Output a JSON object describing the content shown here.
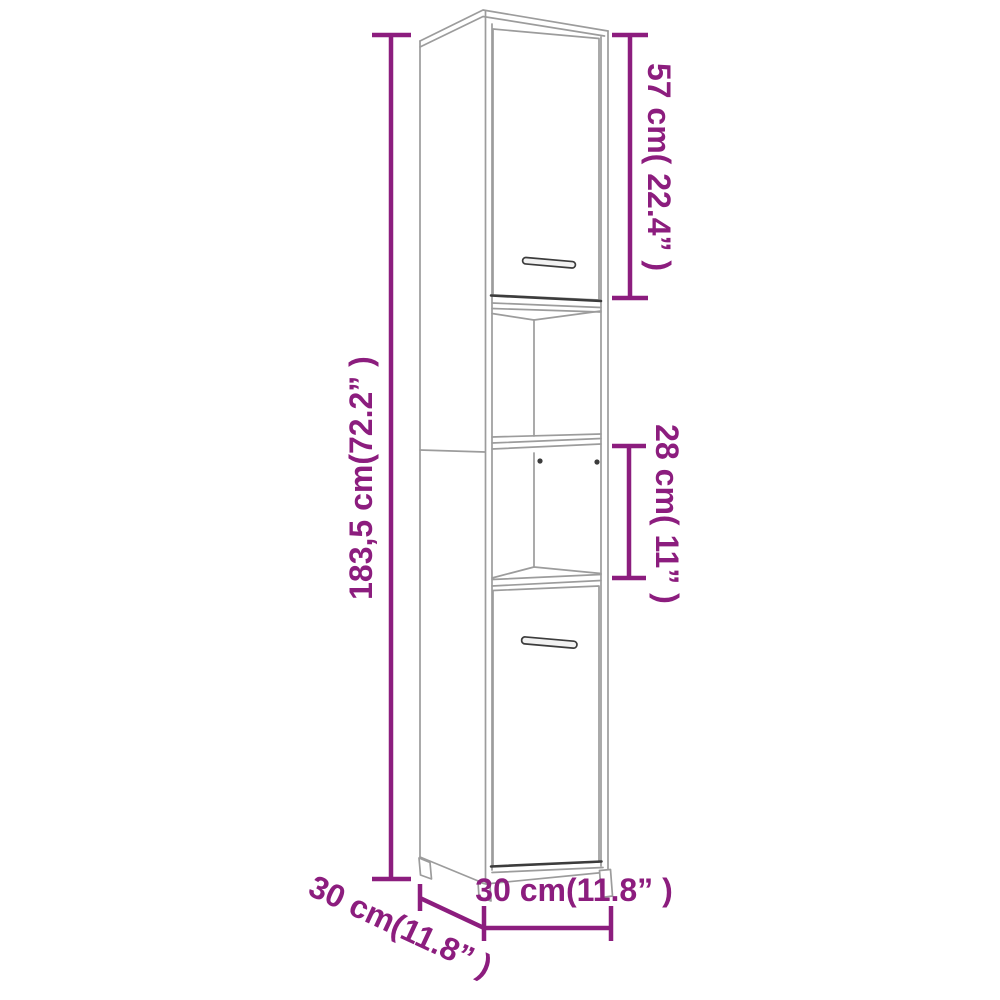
{
  "diagram": {
    "type": "product-dimension-diagram",
    "subject": "tall narrow storage cabinet with top door, two open shelf compartments and bottom door",
    "background": "#ffffff",
    "accent_color": "#8c1d7e",
    "line_color": "#9c9c9c",
    "dark_line_color": "#3c3c3c",
    "handle_fill": "#f2f2f2"
  },
  "labels": {
    "overall_height": "183,5 cm(72.2” )",
    "top_door_height": "57 cm( 22.4” )",
    "open_shelf_height": "28 cm( 11” )",
    "front_width": "30 cm(11.8” )",
    "side_depth": "30 cm(11.8” )"
  },
  "measurements": {
    "overall_height_cm": 183.5,
    "overall_height_in": 72.2,
    "top_door_cm": 57,
    "top_door_in": 22.4,
    "open_shelf_cm": 28,
    "open_shelf_in": 11,
    "width_cm": 30,
    "width_in": 11.8,
    "depth_cm": 30,
    "depth_in": 11.8
  }
}
